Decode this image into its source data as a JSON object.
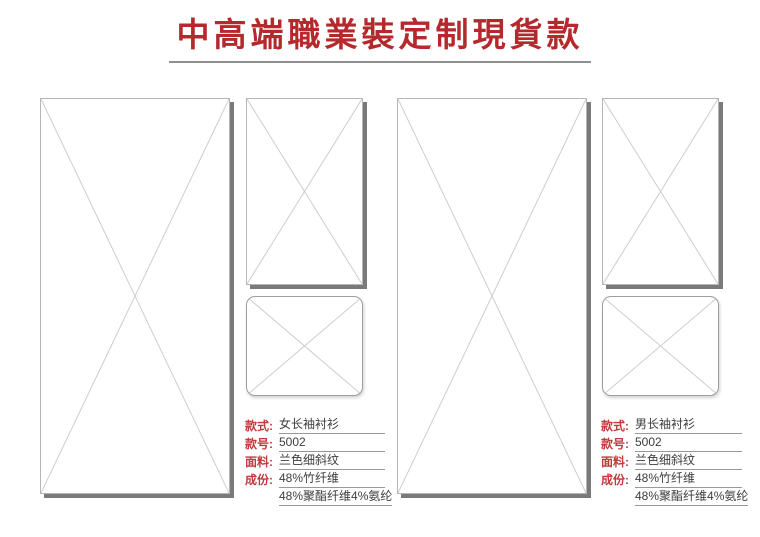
{
  "title": {
    "text": "中高端職業裝定制現貨款"
  },
  "products": [
    {
      "id": "women-shirt",
      "fields": [
        {
          "label": "款式:",
          "value": "女长袖衬衫"
        },
        {
          "label": "款号:",
          "value": "5002"
        },
        {
          "label": "面料:",
          "value": "兰色细斜纹"
        },
        {
          "label": "成份:",
          "value": "48%竹纤维"
        },
        {
          "label": "",
          "value": "48%聚酯纤维4%氨纶"
        }
      ]
    },
    {
      "id": "men-shirt",
      "fields": [
        {
          "label": "款式:",
          "value": "男长袖衬衫"
        },
        {
          "label": "款号:",
          "value": "5002"
        },
        {
          "label": "面料:",
          "value": "兰色细斜纹"
        },
        {
          "label": "成份:",
          "value": "48%竹纤维"
        },
        {
          "label": "",
          "value": "48%聚酯纤维4%氨纶"
        }
      ]
    }
  ],
  "colors": {
    "title_red": "#B5292C",
    "label_red": "#C13A3C",
    "value_text": "#3D3D3D",
    "underline_gray": "#999999",
    "placeholder_border": "#B5B5B5",
    "placeholder_cross": "#CDCDCD",
    "shadow_gray": "#7A7A7A",
    "title_rule_gray": "#8F8F8F"
  }
}
